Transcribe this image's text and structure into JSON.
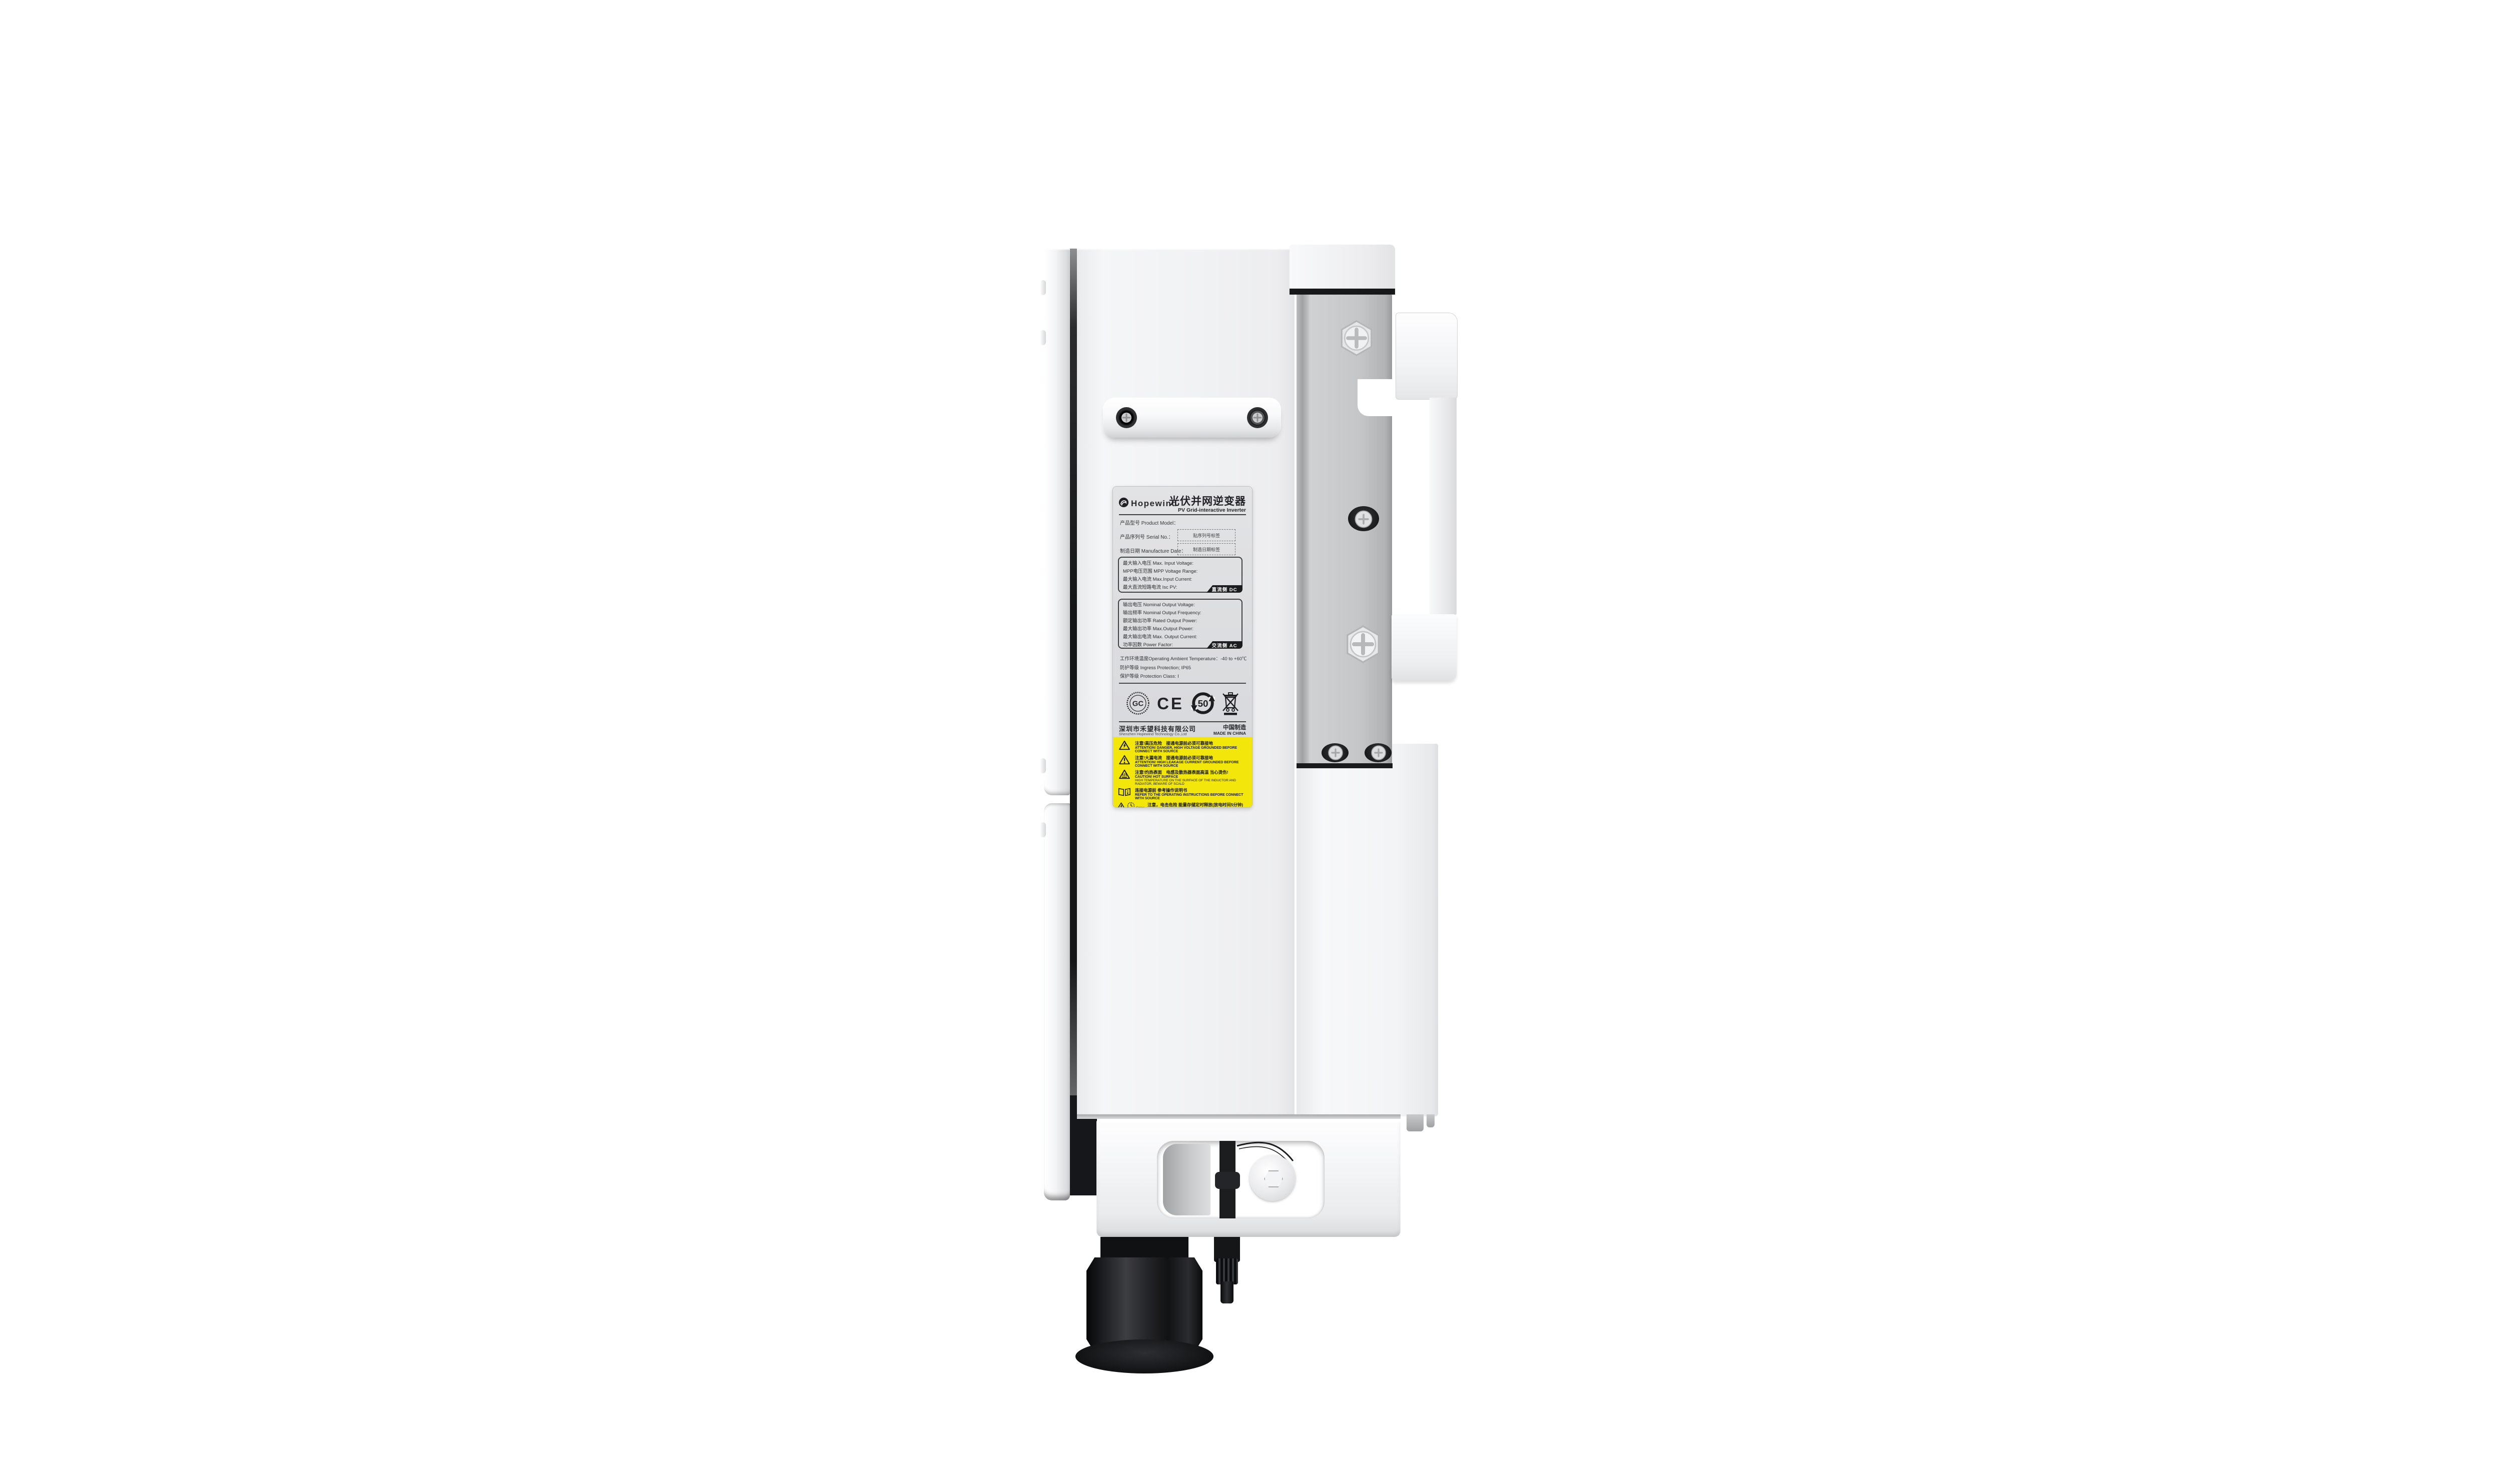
{
  "scene": {
    "description": "side view product photo of a wall-mounted PV inverter",
    "background": "#ffffff"
  },
  "colors": {
    "label_gray": "#dcdde0",
    "warning_yellow": "#f2e60b",
    "metal_gray": "#c4c6c8",
    "enclosure_white": "#f1f2f3",
    "black": "#15161a"
  },
  "brand": {
    "name": "Hopewind",
    "logo": "hopewind-swirl-logo"
  },
  "label": {
    "title_cn": "光伏并网逆变器",
    "title_en": "PV Grid-interactive Inverter",
    "fields": {
      "model": "产品型号 Product Model：",
      "serial": "产品序列号 Serial No.：",
      "date": "制造日期 Manufacture Date："
    },
    "stickers": {
      "serial": "贴序列号标签",
      "date": "制造日期标签"
    },
    "dc": {
      "rows": [
        "最大输入电压 Max. Input Voltage:",
        "MPP电压范围 MPP Voltage Range:",
        "最大输入电流 Max.Input Current:",
        "最大直流短路电流 Isc PV:"
      ],
      "tag": "直流侧 DC"
    },
    "ac": {
      "rows": [
        "输出电压 Nominal Output Voltage:",
        "输出频率 Nominal Output Frequency:",
        "额定输出功率 Rated Output Power:",
        "最大输出功率 Max.Output Power:",
        "最大输出电流 Max. Output Current:",
        "功率因数 Power Factor:"
      ],
      "tag": "交流侧 AC"
    },
    "env_rows": [
      "工作环境温度Operating Ambient Temperature：-40 to +60℃",
      "防护等级 Ingress Protection; IP65",
      "保护等级 Protection Class: I"
    ],
    "cn_cert_letters": "GC",
    "ce_mark": "CE",
    "efup_years": "50",
    "company_cn": "深圳市禾望科技有限公司",
    "company_en": "Shenzhen Hopewind Technology Co.,Ltd",
    "made_cn": "中国制造",
    "made_en": "MADE IN CHINA",
    "warnings": [
      {
        "cn": "注意!高压危险　接通电源前必须可靠接地",
        "en": "ATTENTION!  DANGER, HIGH VOLTAGE    GROUNDED BEFORE CONNECT WITH SOURCE"
      },
      {
        "cn": "注意!大漏电流　接通电源前必须可靠接地",
        "en": "ATTENTION!  HIGH LEAKAGE CURRENT    GROUNDED BEFORE CONNECT WITH SOURCE"
      },
      {
        "cn": "注意!灼热表面　电感及散热器表面高温 当心烫伤!",
        "en": "CAUTION!  HOT SURFACE",
        "en2": "HIGH TEMPERATURE ON THE SURFACE OF THE  INDUCTOR AND RADIATOR, BEWARE OF SCALD"
      },
      {
        "cn": "连接电源前 参考操作说明书",
        "en": "REFER TO THE OPERATING INSTRUCTIONS BEFORE CONNECT WITH SOURCE"
      },
      {
        "cn": "注意，电击危险 能量存储定时释放(放电时间5分钟)",
        "en": "RISK OF ELECTRIC SHOCK, ENERGY STORAGE TIMED DISCHARGE (TIME TO BE 5 MINUTES)",
        "clock": "5mins"
      }
    ],
    "icons": [
      "hopewind-logo-icon",
      "cn-energy-cert-icon",
      "ce-mark-icon",
      "efup-50-icon",
      "weee-bin-icon",
      "high-voltage-warning-icon",
      "leakage-current-warning-icon",
      "hot-surface-warning-icon",
      "manual-book-icon",
      "discharge-clock-icon"
    ]
  }
}
